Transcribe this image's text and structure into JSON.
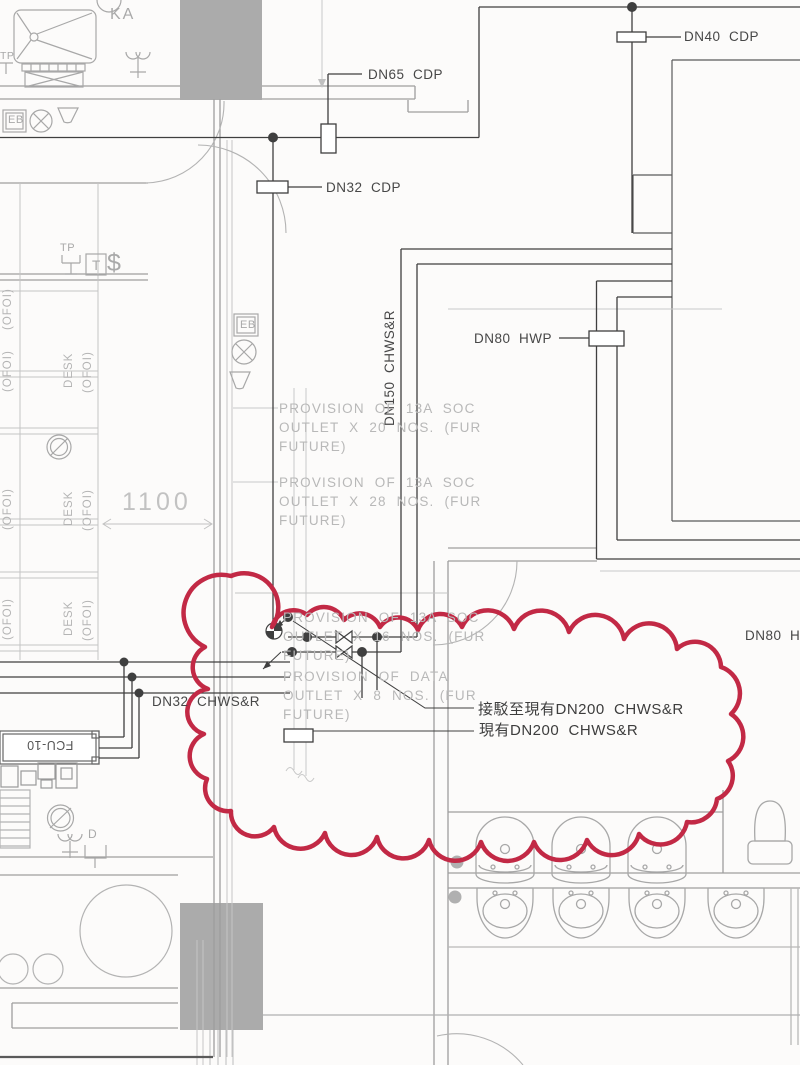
{
  "labels": {
    "dn40_cdp": "DN40  CDP",
    "dn65_cdp": "DN65  CDP",
    "dn32_cdp": "DN32  CDP",
    "dn150_chwsr": "DN150  CHWS&R",
    "dn80_hwp": "DN80  HWP",
    "dn32_chwsr": "DN32  CHWS&R",
    "dn80_h_clipped": "DN80  H",
    "connect_to_existing_dn200": "接駁至現有DN200  CHWS&R",
    "existing_dn200": "現有DN200  CHWS&R"
  },
  "notes": {
    "soc_20": "PROVISION OF 13A SOC\nOUTLET X 20 NOS. (FUR\nFUTURE)",
    "soc_28": "PROVISION OF 13A SOC\nOUTLET X 28 NOS. (FUR\nFUTURE)",
    "soc_16": "PROVISION OF 13A SOC\nOUTLET X 16 NOS. (FUR\nFUTURE)",
    "data_8": "PROVISION OF DATA\nOUTLET X 8 NOS. (FUR\nFUTURE)"
  },
  "room_labels": {
    "ka": "KA",
    "tp": "TP",
    "t": "T",
    "dollar": "$",
    "eb": "EB",
    "d": "D",
    "desk": "DESK",
    "ofoi": "(OFOI)",
    "fcu": "FCU-10"
  },
  "dimensions": {
    "aisle_width": "1100"
  },
  "colors": {
    "revision_cloud": "#c22945",
    "pipe_line": "#3f3f3f",
    "wall": "#9e9e9e",
    "faint": "#c6c6c6",
    "note_text": "#b8b8b8",
    "column_fill": "#ababab"
  }
}
